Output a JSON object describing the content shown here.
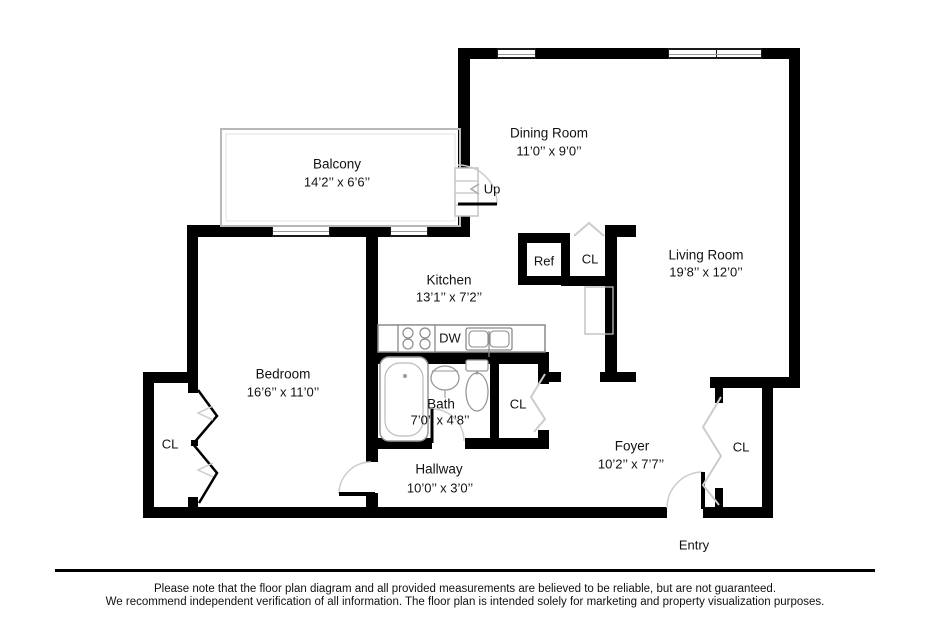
{
  "plan": {
    "rooms": {
      "balcony": {
        "name": "Balcony",
        "dims": "14’2’’ x 6’6’’"
      },
      "dining": {
        "name": "Dining Room",
        "dims": "11’0’’ x 9’0’’"
      },
      "living": {
        "name": "Living Room",
        "dims": "19’8’’ x 12’0’’"
      },
      "kitchen": {
        "name": "Kitchen",
        "dims": "13’1’’ x 7’2’’"
      },
      "bedroom": {
        "name": "Bedroom",
        "dims": "16’6’’ x 11’0’’"
      },
      "bath": {
        "name": "Bath",
        "dims": "7’0’’ x 4’8’’"
      },
      "hallway": {
        "name": "Hallway",
        "dims": "10’0’’ x 3’0’’"
      },
      "foyer": {
        "name": "Foyer",
        "dims": "10’2’’ x 7’7’’"
      }
    },
    "fixtures": {
      "closet": "CL",
      "refrigerator": "Ref",
      "dishwasher": "DW",
      "stairs_up": "Up",
      "entry": "Entry"
    }
  },
  "colors": {
    "wall": "#000000",
    "fixture_outline": "#999999",
    "door_arc": "#cccccc",
    "text": "#111111"
  },
  "disclaimer": {
    "line1": "Please note that the floor plan diagram and all provided measurements are believed to be reliable, but are not guaranteed.",
    "line2": "We recommend independent verification of all information. The floor plan is intended solely for marketing and property visualization purposes."
  }
}
